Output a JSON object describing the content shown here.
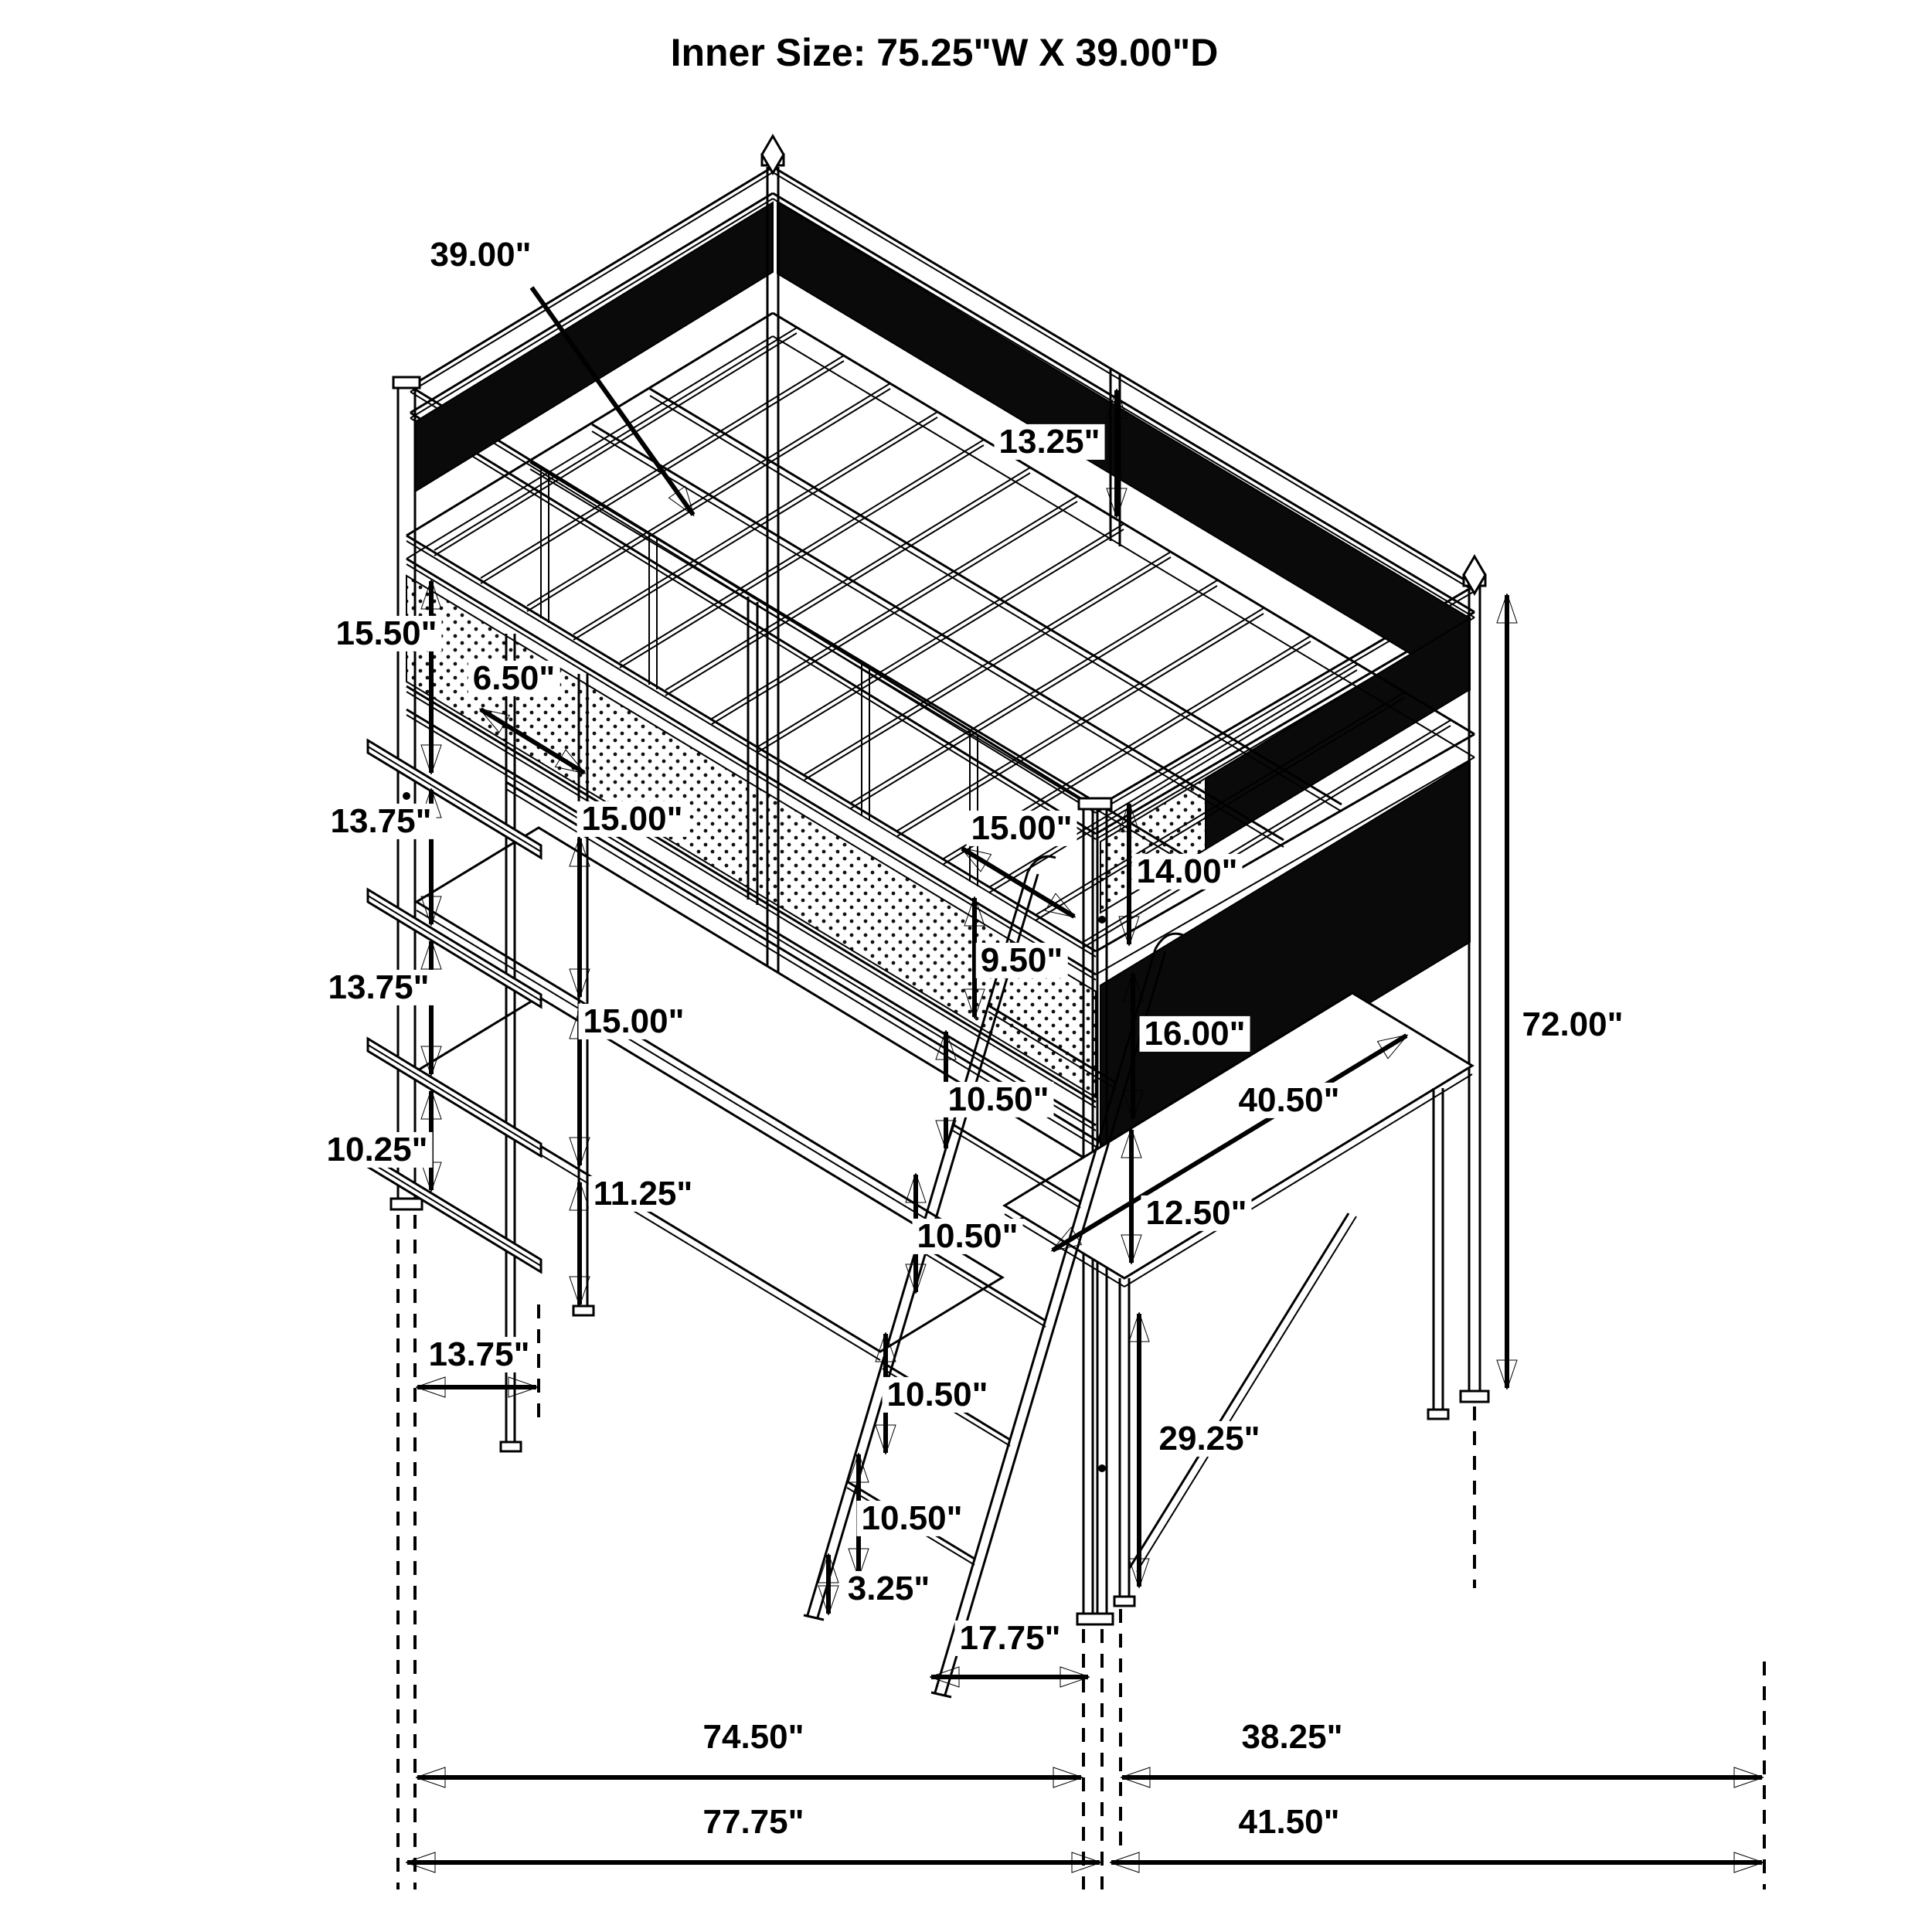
{
  "title": "Inner Size: 75.25\"W X 39.00\"D",
  "colors": {
    "ink": "#000000",
    "background": "#ffffff",
    "mesh": "#0a0a0a"
  },
  "dimensions": {
    "inner_depth": "39.00\"",
    "guardrail_height": "13.25\"",
    "shelf_gap_top": "15.50\"",
    "post_offset": "6.50\"",
    "shelf_gap_mid_upper": "13.75\"",
    "shelf_gap_mid_lower": "13.75\"",
    "shelf_depth": "13.75\"",
    "shelf_gap_bottom": "10.25\"",
    "desk_gap_upper": "15.00\"",
    "desk_gap_lower": "15.00\"",
    "deck_edge": "15.00\"",
    "strut_bottom": "11.25\"",
    "ladder_top_gap": "9.50\"",
    "end_panel_upper": "14.00\"",
    "end_panel_lower": "16.00\"",
    "rung_gap_1": "10.50\"",
    "rung_gap_2": "10.50\"",
    "rung_gap_3": "10.50\"",
    "rung_gap_4": "10.50\"",
    "desk_reach": "40.50\"",
    "desk_clearance": "12.50\"",
    "desk_height": "29.25\"",
    "total_height": "72.00\"",
    "ladder_foot": "3.25\"",
    "ladder_offset": "17.75\"",
    "width_inner_base": "74.50\"",
    "depth_inner_base": "38.25\"",
    "width_overall": "77.75\"",
    "depth_overall": "41.50\""
  }
}
